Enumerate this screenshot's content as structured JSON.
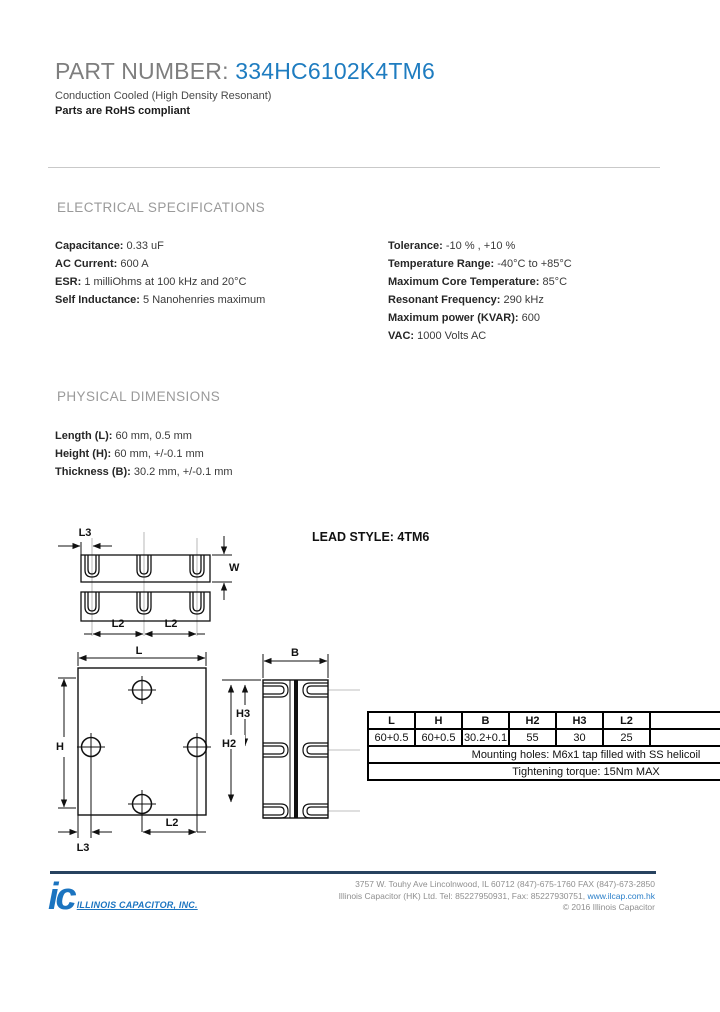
{
  "header": {
    "part_label": "PART NUMBER:",
    "part_number": "334HC6102K4TM6",
    "subtitle": "Conduction Cooled (High Density Resonant)",
    "rohs": "Parts are RoHS compliant"
  },
  "electrical": {
    "heading": "ELECTRICAL SPECIFICATIONS",
    "left": [
      {
        "label": "Capacitance:",
        "value": " 0.33 uF"
      },
      {
        "label": "AC Current:",
        "value": " 600 A"
      },
      {
        "label": "ESR:",
        "value": " 1 milliOhms at 100 kHz and 20°C"
      },
      {
        "label": "Self Inductance:",
        "value": " 5 Nanohenries maximum"
      }
    ],
    "right": [
      {
        "label": "Tolerance:",
        "value": " -10 % , +10 %"
      },
      {
        "label": "Temperature Range:",
        "value": " -40°C to +85°C"
      },
      {
        "label": "Maximum Core Temperature:",
        "value": " 85°C"
      },
      {
        "label": "Resonant Frequency:",
        "value": " 290 kHz"
      },
      {
        "label": "Maximum power (KVAR):",
        "value": " 600"
      },
      {
        "label": "VAC:",
        "value": " 1000 Volts AC"
      }
    ]
  },
  "physical": {
    "heading": "PHYSICAL DIMENSIONS",
    "items": [
      {
        "label": "Length (L):",
        "value": " 60 mm, 0.5 mm"
      },
      {
        "label": "Height (H):",
        "value": " 60 mm, +/-0.1 mm"
      },
      {
        "label": "Thickness (B):",
        "value": " 30.2 mm, +/-0.1 mm"
      }
    ]
  },
  "drawings": {
    "lead_style_label": "LEAD STYLE: 4TM6",
    "top_view": {
      "l3": "L3",
      "w": "W",
      "l2_left": "L2",
      "l2_right": "L2"
    },
    "front_view": {
      "l": "L",
      "h": "H",
      "l2": "L2",
      "l3": "L3"
    },
    "side_view": {
      "b": "B",
      "h3": "H3",
      "h2": "H2"
    }
  },
  "dim_table": {
    "headers": [
      "L",
      "H",
      "B",
      "H2",
      "H3",
      "L2"
    ],
    "values": [
      "60+0.5",
      "60+0.5",
      "30.2+0.1",
      "55",
      "30",
      "25"
    ],
    "mounting_note": "Mounting holes: M6x1 tap filled with SS helicoil",
    "torque_note": "Tightening torque: 15Nm MAX"
  },
  "footer": {
    "logo_mark": "ic",
    "logo_text": "ILLINOIS CAPACITOR, INC.",
    "address_line1": "3757 W. Touhy Ave    Lincolnwood, IL 60712   (847)-675-1760  FAX (847)-673-2850",
    "address_line2_prefix": "Illinois Capacitor (HK) Ltd.  Tel: 85227950931, Fax: 85227930751, ",
    "address_line2_link": "www.ilcap.com.hk",
    "copyright": "© 2016 Illinois Capacitor"
  },
  "colors": {
    "accent_blue": "#1e7cc0",
    "logo_blue": "#1b74c0",
    "footer_bar": "#27425f",
    "link_blue": "#2a7fc9"
  }
}
